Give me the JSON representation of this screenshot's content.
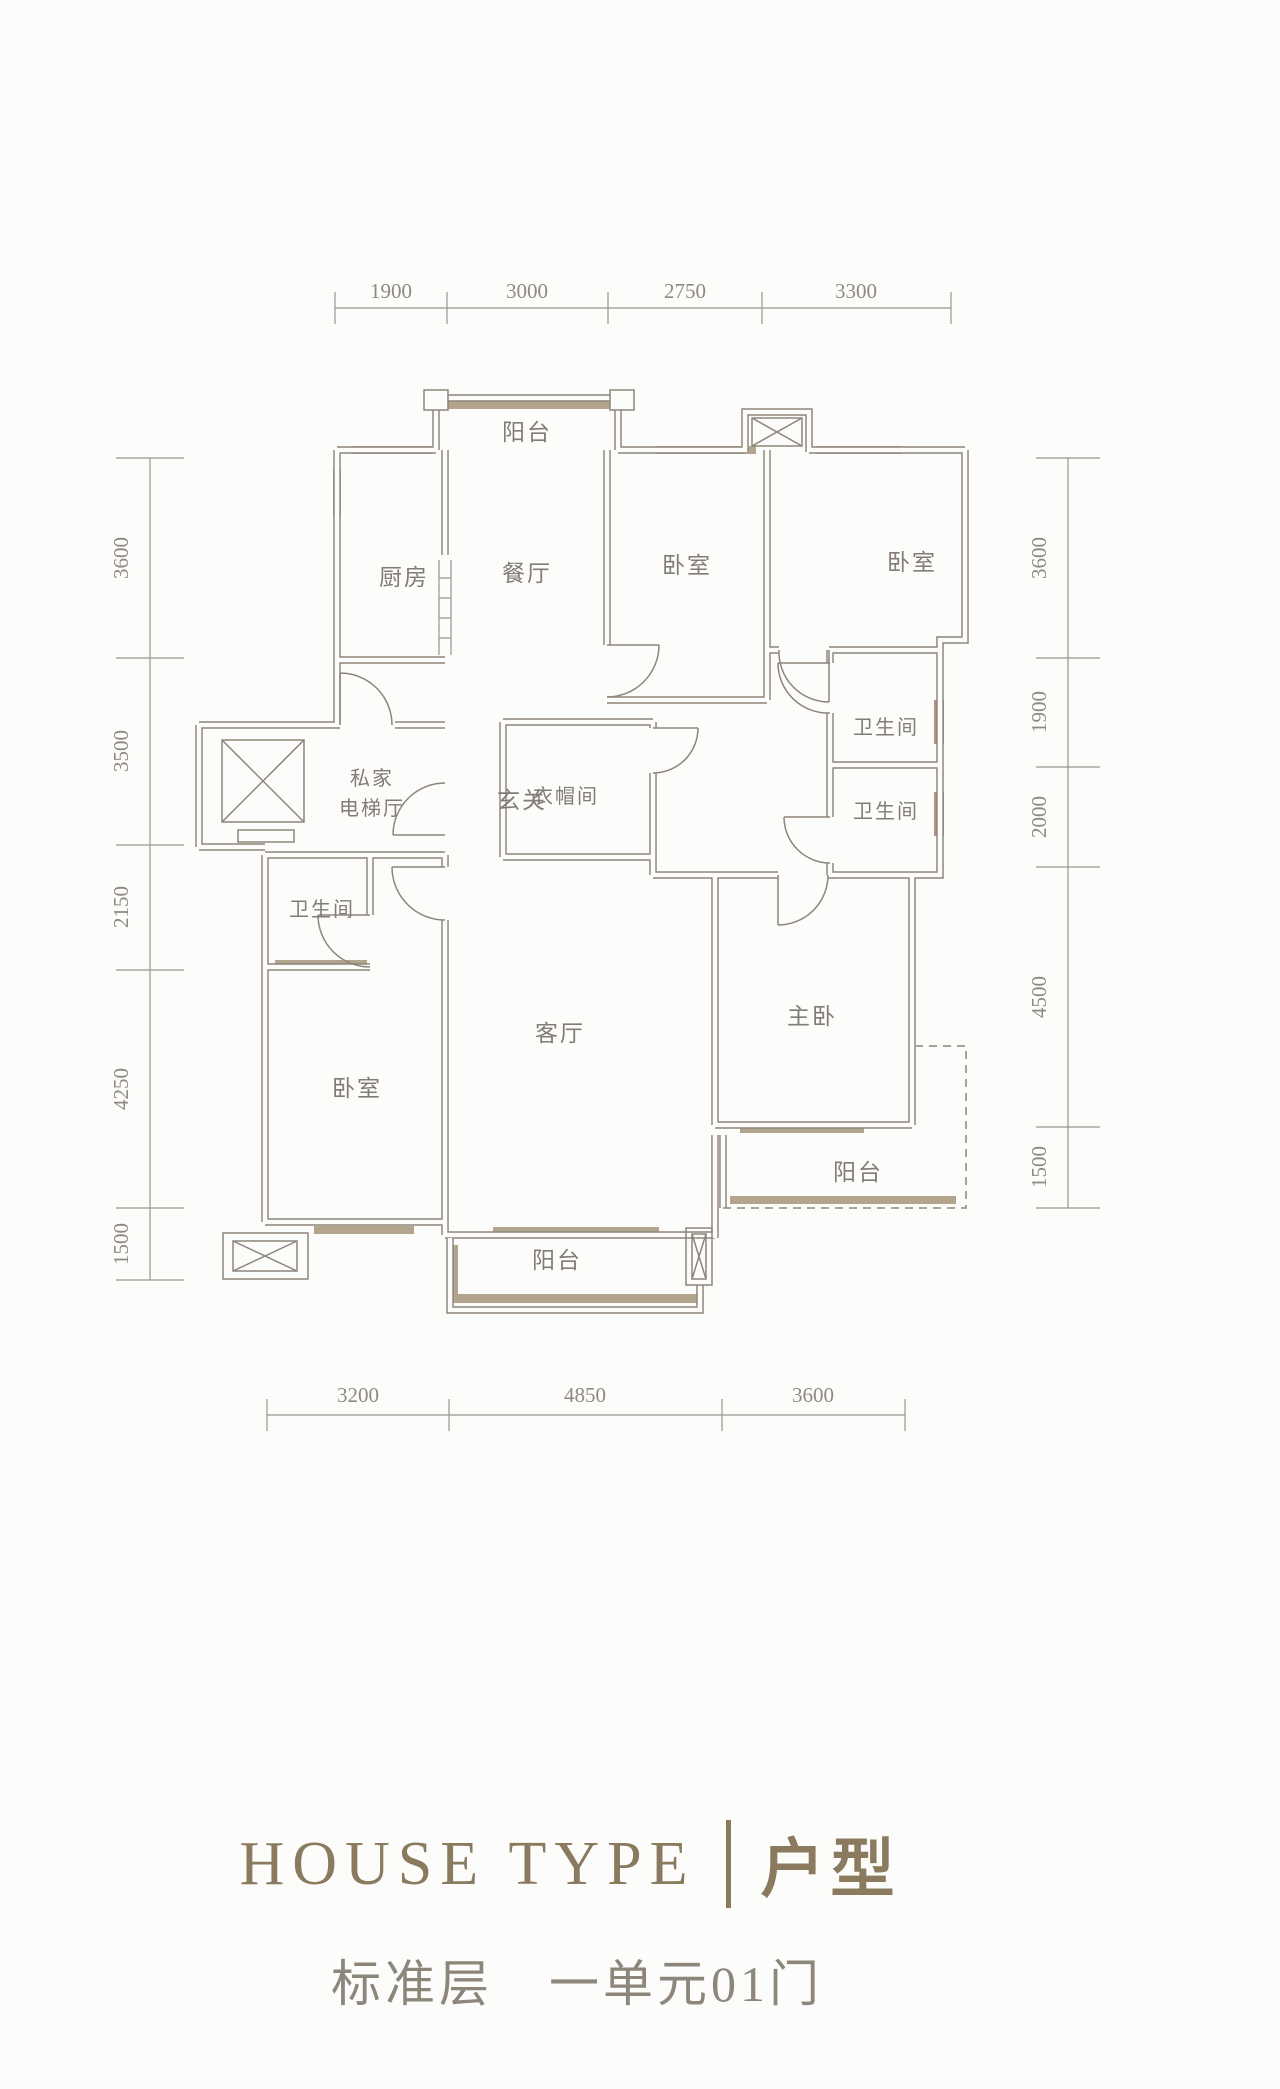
{
  "plan": {
    "rooms": [
      {
        "id": "balcony-top",
        "label": "阳台"
      },
      {
        "id": "kitchen",
        "label": "厨房"
      },
      {
        "id": "dining-room",
        "label": "餐厅"
      },
      {
        "id": "bedroom-top-1",
        "label": "卧室"
      },
      {
        "id": "bedroom-top-2",
        "label": "卧室"
      },
      {
        "id": "private-elevator-hall-line1",
        "label": "私家"
      },
      {
        "id": "private-elevator-hall-line2",
        "label": "电梯厅"
      },
      {
        "id": "foyer",
        "label": "玄关"
      },
      {
        "id": "cloakroom",
        "label": "衣帽间"
      },
      {
        "id": "bathroom-right-1",
        "label": "卫生间"
      },
      {
        "id": "bathroom-right-2",
        "label": "卫生间"
      },
      {
        "id": "bathroom-left",
        "label": "卫生间"
      },
      {
        "id": "living-room",
        "label": "客厅"
      },
      {
        "id": "master-bedroom",
        "label": "主卧"
      },
      {
        "id": "bedroom-left",
        "label": "卧室"
      },
      {
        "id": "balcony-bottom",
        "label": "阳台"
      },
      {
        "id": "balcony-right",
        "label": "阳台"
      }
    ],
    "dims": {
      "top": [
        "1900",
        "3000",
        "2750",
        "3300"
      ],
      "bottom": [
        "3200",
        "4850",
        "3600"
      ],
      "left": [
        "3600",
        "3500",
        "2150",
        "4250",
        "1500"
      ],
      "right": [
        "3600",
        "1900",
        "2000",
        "4500",
        "1500"
      ]
    }
  },
  "footer": {
    "title_en": "HOUSE TYPE",
    "title_zh": "户型",
    "subtitle_floor": "标准层",
    "subtitle_unit": "一单元01门"
  },
  "colors": {
    "wall": "#8d857a",
    "window_band": "#b3a48e",
    "red_window_band": "#b5776d",
    "dimension_line": "#9a958d",
    "dimension_text": "#8f897f",
    "room_text": "#827c74",
    "accent_title": "#8a7a5e",
    "subtitle_text": "#8c867b",
    "background": "#fcfcfb"
  }
}
